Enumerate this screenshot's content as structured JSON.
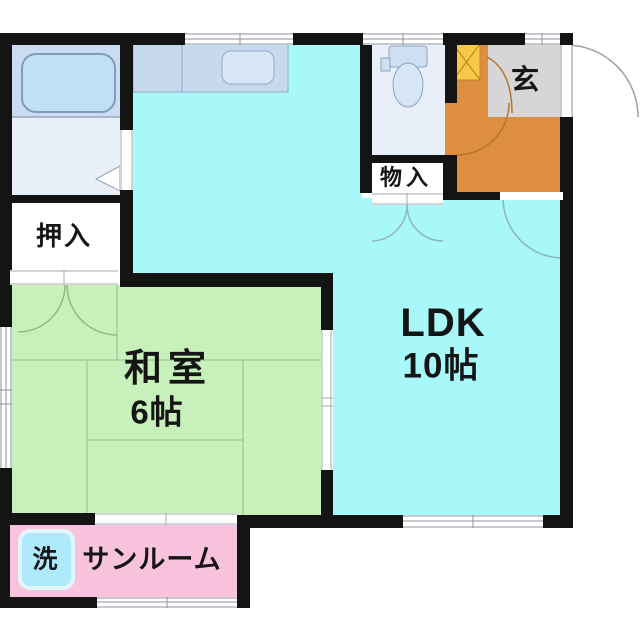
{
  "title": "1LDK apartment floor plan",
  "rooms": {
    "washitsu": {
      "name": "和室",
      "size": "6帖"
    },
    "ldk": {
      "name": "LDK",
      "size": "10帖"
    },
    "oshiire": {
      "name": "押入"
    },
    "monoire": {
      "name": "物入"
    },
    "genkan": {
      "name": "玄"
    },
    "sunroom": {
      "name": "サンルーム"
    },
    "laundry": {
      "name": "洗"
    }
  },
  "fixtures": [
    "bathtub-icon",
    "kitchen-counter-icon",
    "kitchen-sink-icon",
    "toilet-icon",
    "washing-machine-icon",
    "shoe-cabinet-icon"
  ],
  "colors": {
    "wall": "#141414",
    "kitchen_ldk_floor": "#a8f7f9",
    "washitsu_floor": "#c8f0ba",
    "tatami_line": "#a3d096",
    "sunroom_floor": "#f9c3dd",
    "hall_floor": "#dd8e3e",
    "genkan_tile": "#d6d6d8",
    "shoe_cabinet": "#f7c84a",
    "bathroom": "#cbdcf2",
    "fixture_room": "#e9eff9",
    "counter": "#c7d9ef",
    "laundry_box": "#aeeafb",
    "label_text": "#151515"
  }
}
